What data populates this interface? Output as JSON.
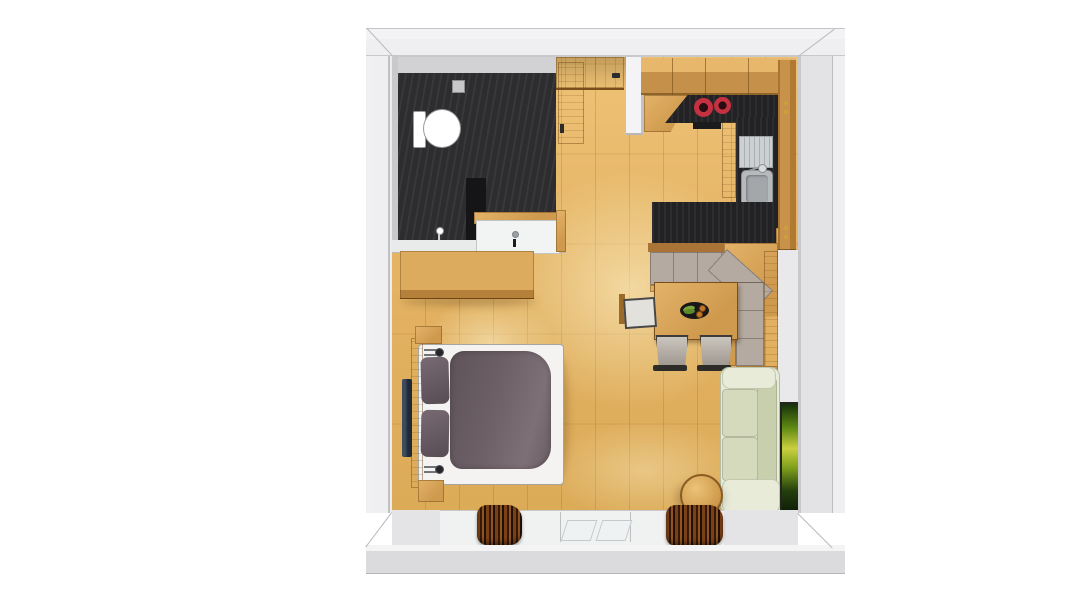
{
  "meta": {
    "description": "3D top-down rendering of a studio apartment floor plan",
    "canvas": {
      "width": 1070,
      "height": 601
    }
  },
  "palette": {
    "wall_outer": "#efeff1",
    "wall_face": "#dbdbdd",
    "wall_edge": "#aeaeb0",
    "wall_inner": "#c9c9cb",
    "floor_light": "#f0c97d",
    "floor_main": "#e5b766",
    "floor_dark": "#d9a854",
    "wood": "#cf9a4e",
    "wood_light": "#e3b369",
    "wood_dark": "#8a5c24",
    "dark_counter": "#222224",
    "bath_floor": "#2d2d2f",
    "burner_red": "#c53140",
    "steel": "#ccd0d2",
    "cushion": "#b5aaa1",
    "chair_grey": "#aca299",
    "chair_white": "#e3e1dc",
    "sofa": "#d6dabd",
    "sofa_light": "#e8ebd8",
    "duvet": "#6d6067",
    "pillow": "#665a62",
    "mattress": "#f4f3f1",
    "curtain_a": "#7a4016",
    "curtain_b": "#36190a",
    "tv": "#1f2938"
  },
  "rooms": {
    "bathroom": {
      "label": "Bathroom",
      "items": {
        "toilet": "Toilet",
        "shower": "Shower",
        "shower_partition": "Shower partition",
        "vanity": "Washbasin vanity",
        "door": "Bathroom door",
        "drain": "Wall vent"
      }
    },
    "entry": {
      "label": "Entry",
      "items": {
        "entrance_door": "Entrance door",
        "partition": "Partition wall"
      }
    },
    "kitchen": {
      "label": "Kitchenette",
      "items": {
        "upper_cabinets": "Upper cabinets",
        "hob": "Two-burner hob",
        "sink": "Kitchen sink",
        "tall_cabinet": "Tall cabinet",
        "bar_counter": "Dark worktop",
        "side_counter": "Counter"
      }
    },
    "dining": {
      "label": "Dining nook",
      "items": {
        "corner_bench": "Corner bench",
        "table": "Dining table",
        "fruit_tray": "Fruit tray",
        "chair_left": "Chair",
        "chair_1": "Chair",
        "chair_2": "Chair"
      }
    },
    "living": {
      "label": "Living area",
      "items": {
        "sofa": "Sofa",
        "stool": "Round stool",
        "artwork": "Wall artwork"
      }
    },
    "sleeping": {
      "label": "Sleeping area",
      "items": {
        "bed": "Double bed",
        "headboard": "Headboard",
        "pillow_1": "Pillow",
        "pillow_2": "Pillow",
        "duvet": "Duvet",
        "tv": "Wall-mounted TV",
        "dresser": "Sideboard",
        "lamp_top": "Reading lamp",
        "lamp_bottom": "Reading lamp"
      }
    },
    "window_wall": {
      "label": "Window wall",
      "items": {
        "curtain_left": "Curtain",
        "curtain_right": "Curtain",
        "window": "Window glazing"
      }
    }
  }
}
